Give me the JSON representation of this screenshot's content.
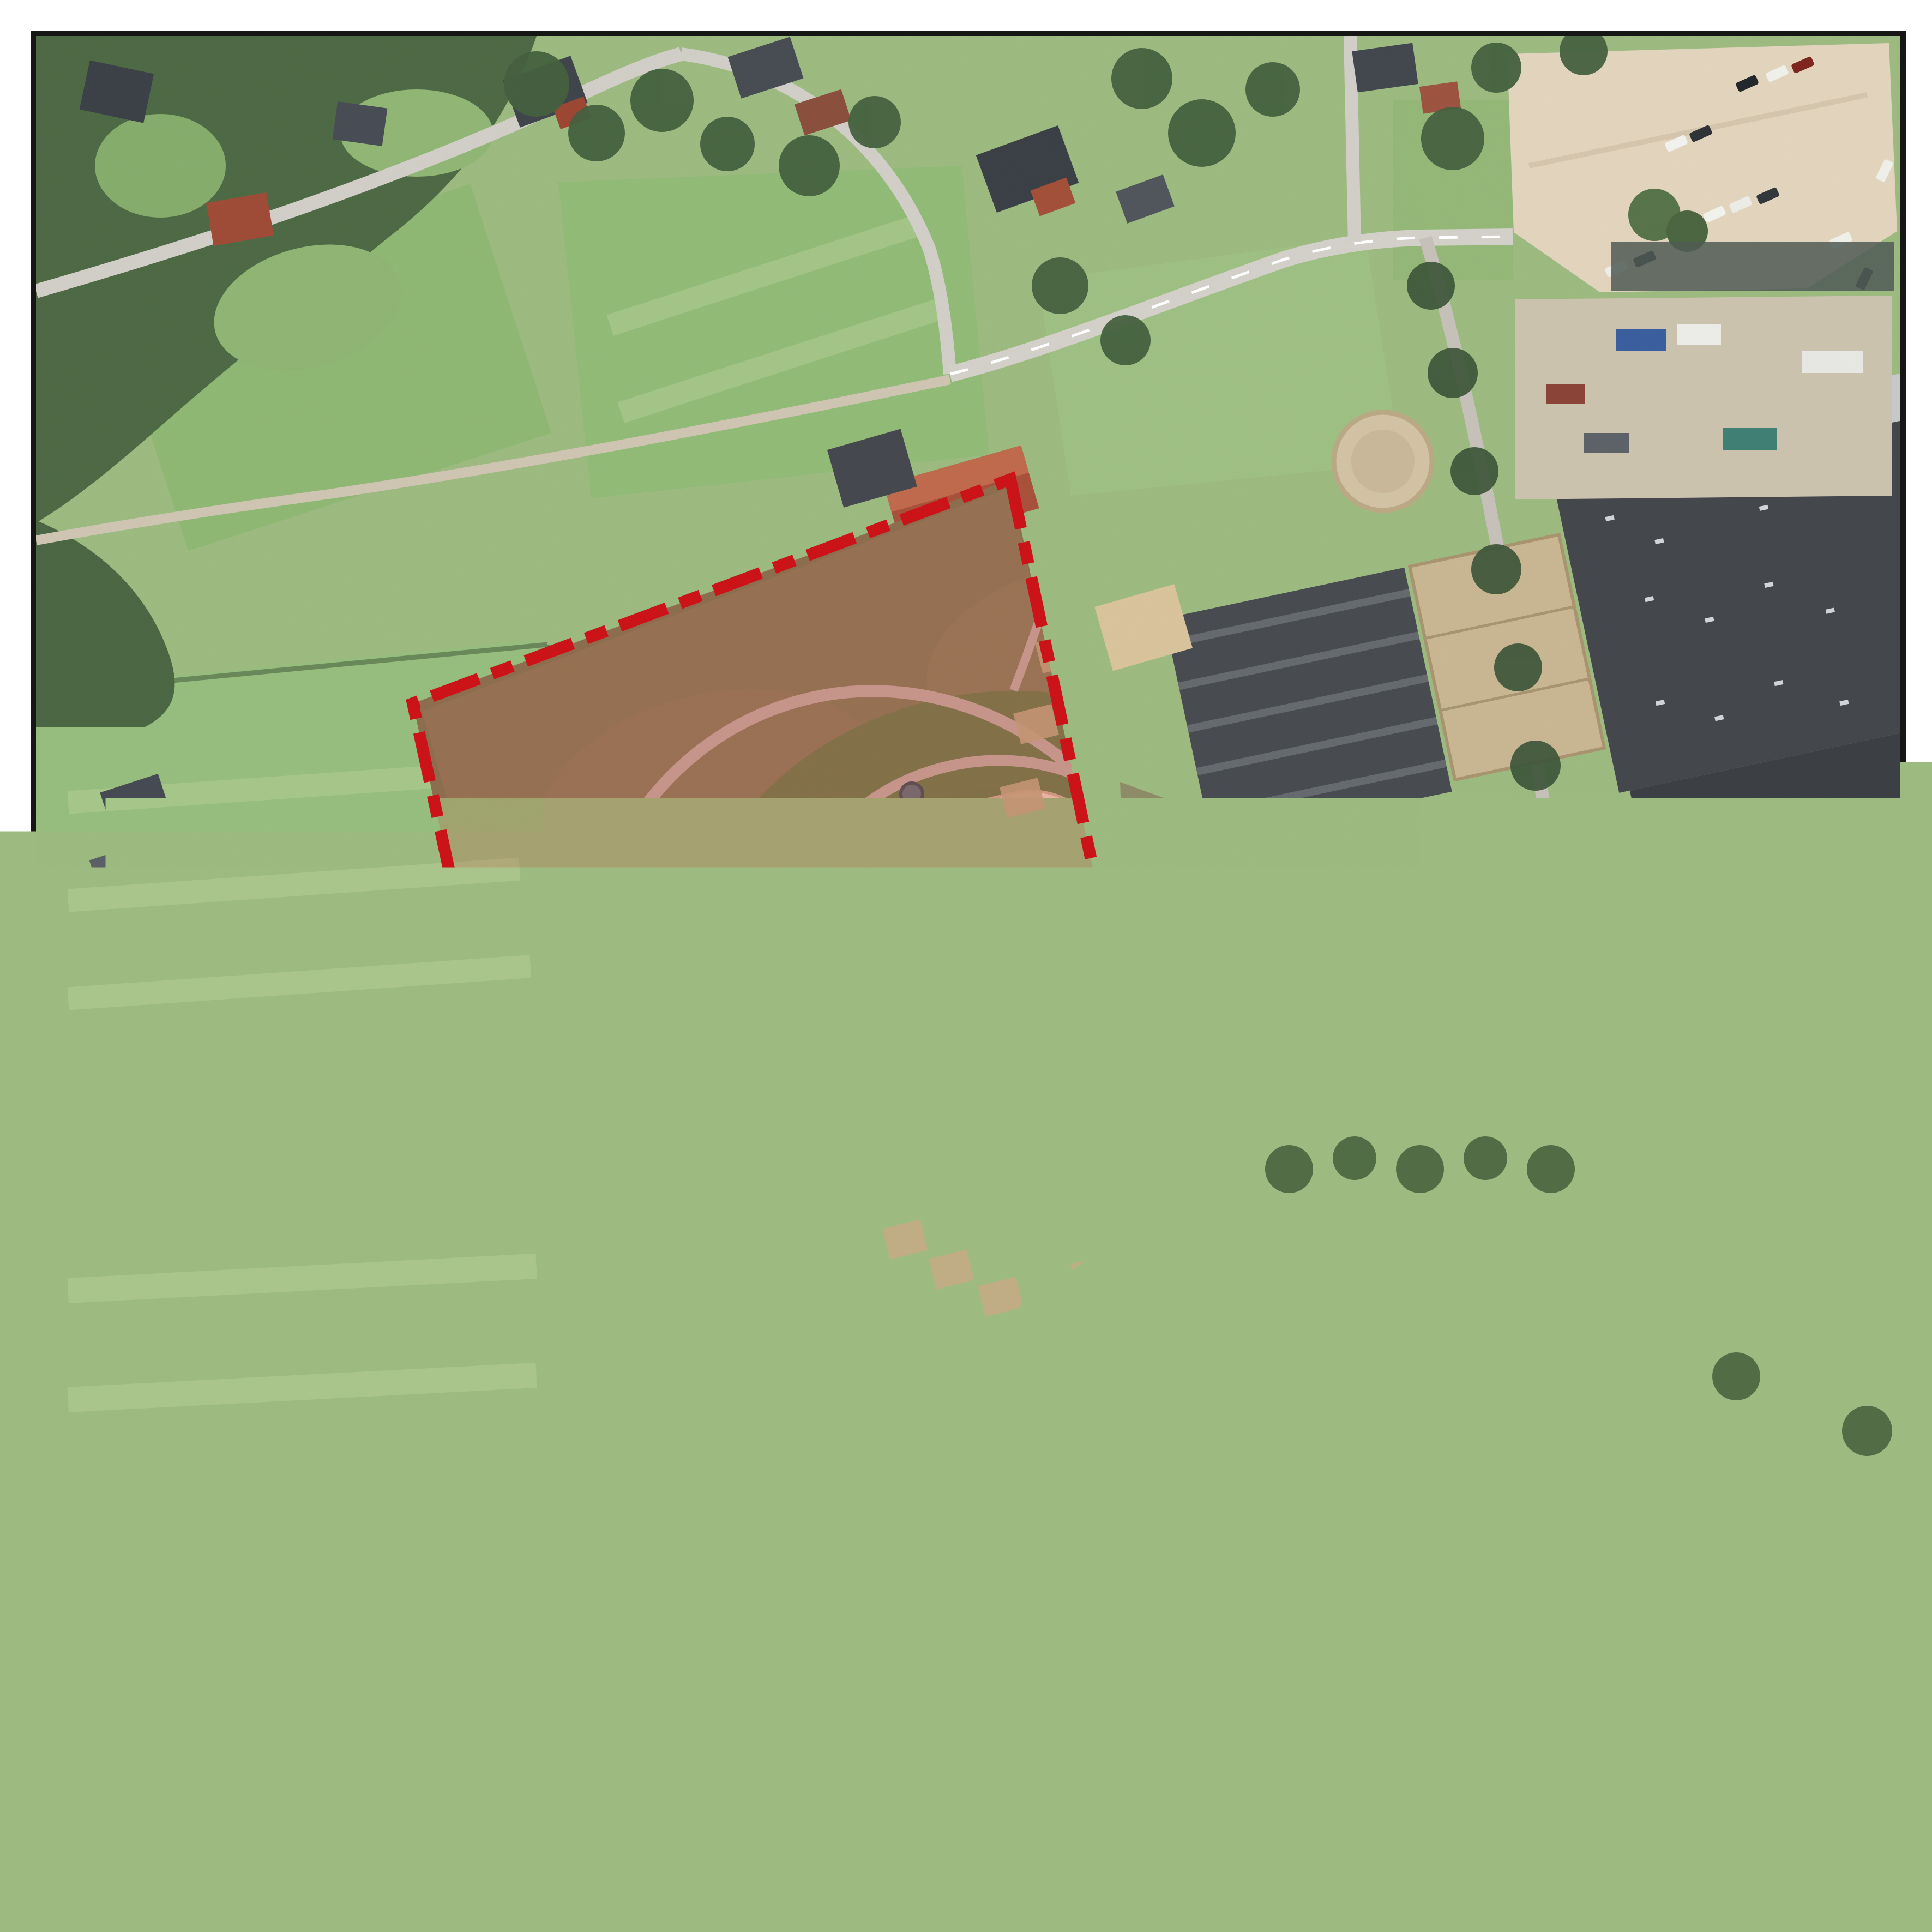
{
  "page": {
    "background": "#FFFFFF",
    "frame_color": "#161616"
  },
  "map": {
    "kind": "aerial-photo with site boundary overlay",
    "site_boundary_color": "#CC1117",
    "site_fill_tint": "rgba(200,62,50,0.20)"
  },
  "legend": {
    "scale_labels": [
      "0",
      "20",
      "40",
      "60",
      "80 m"
    ],
    "bar_colors": [
      "#000000",
      "#FFFFFF",
      "#000000",
      "#FFFFFF"
    ]
  },
  "north_arrow": {
    "color": "#A32168"
  },
  "logo": {
    "letter": "R",
    "color": "#C0087B"
  }
}
